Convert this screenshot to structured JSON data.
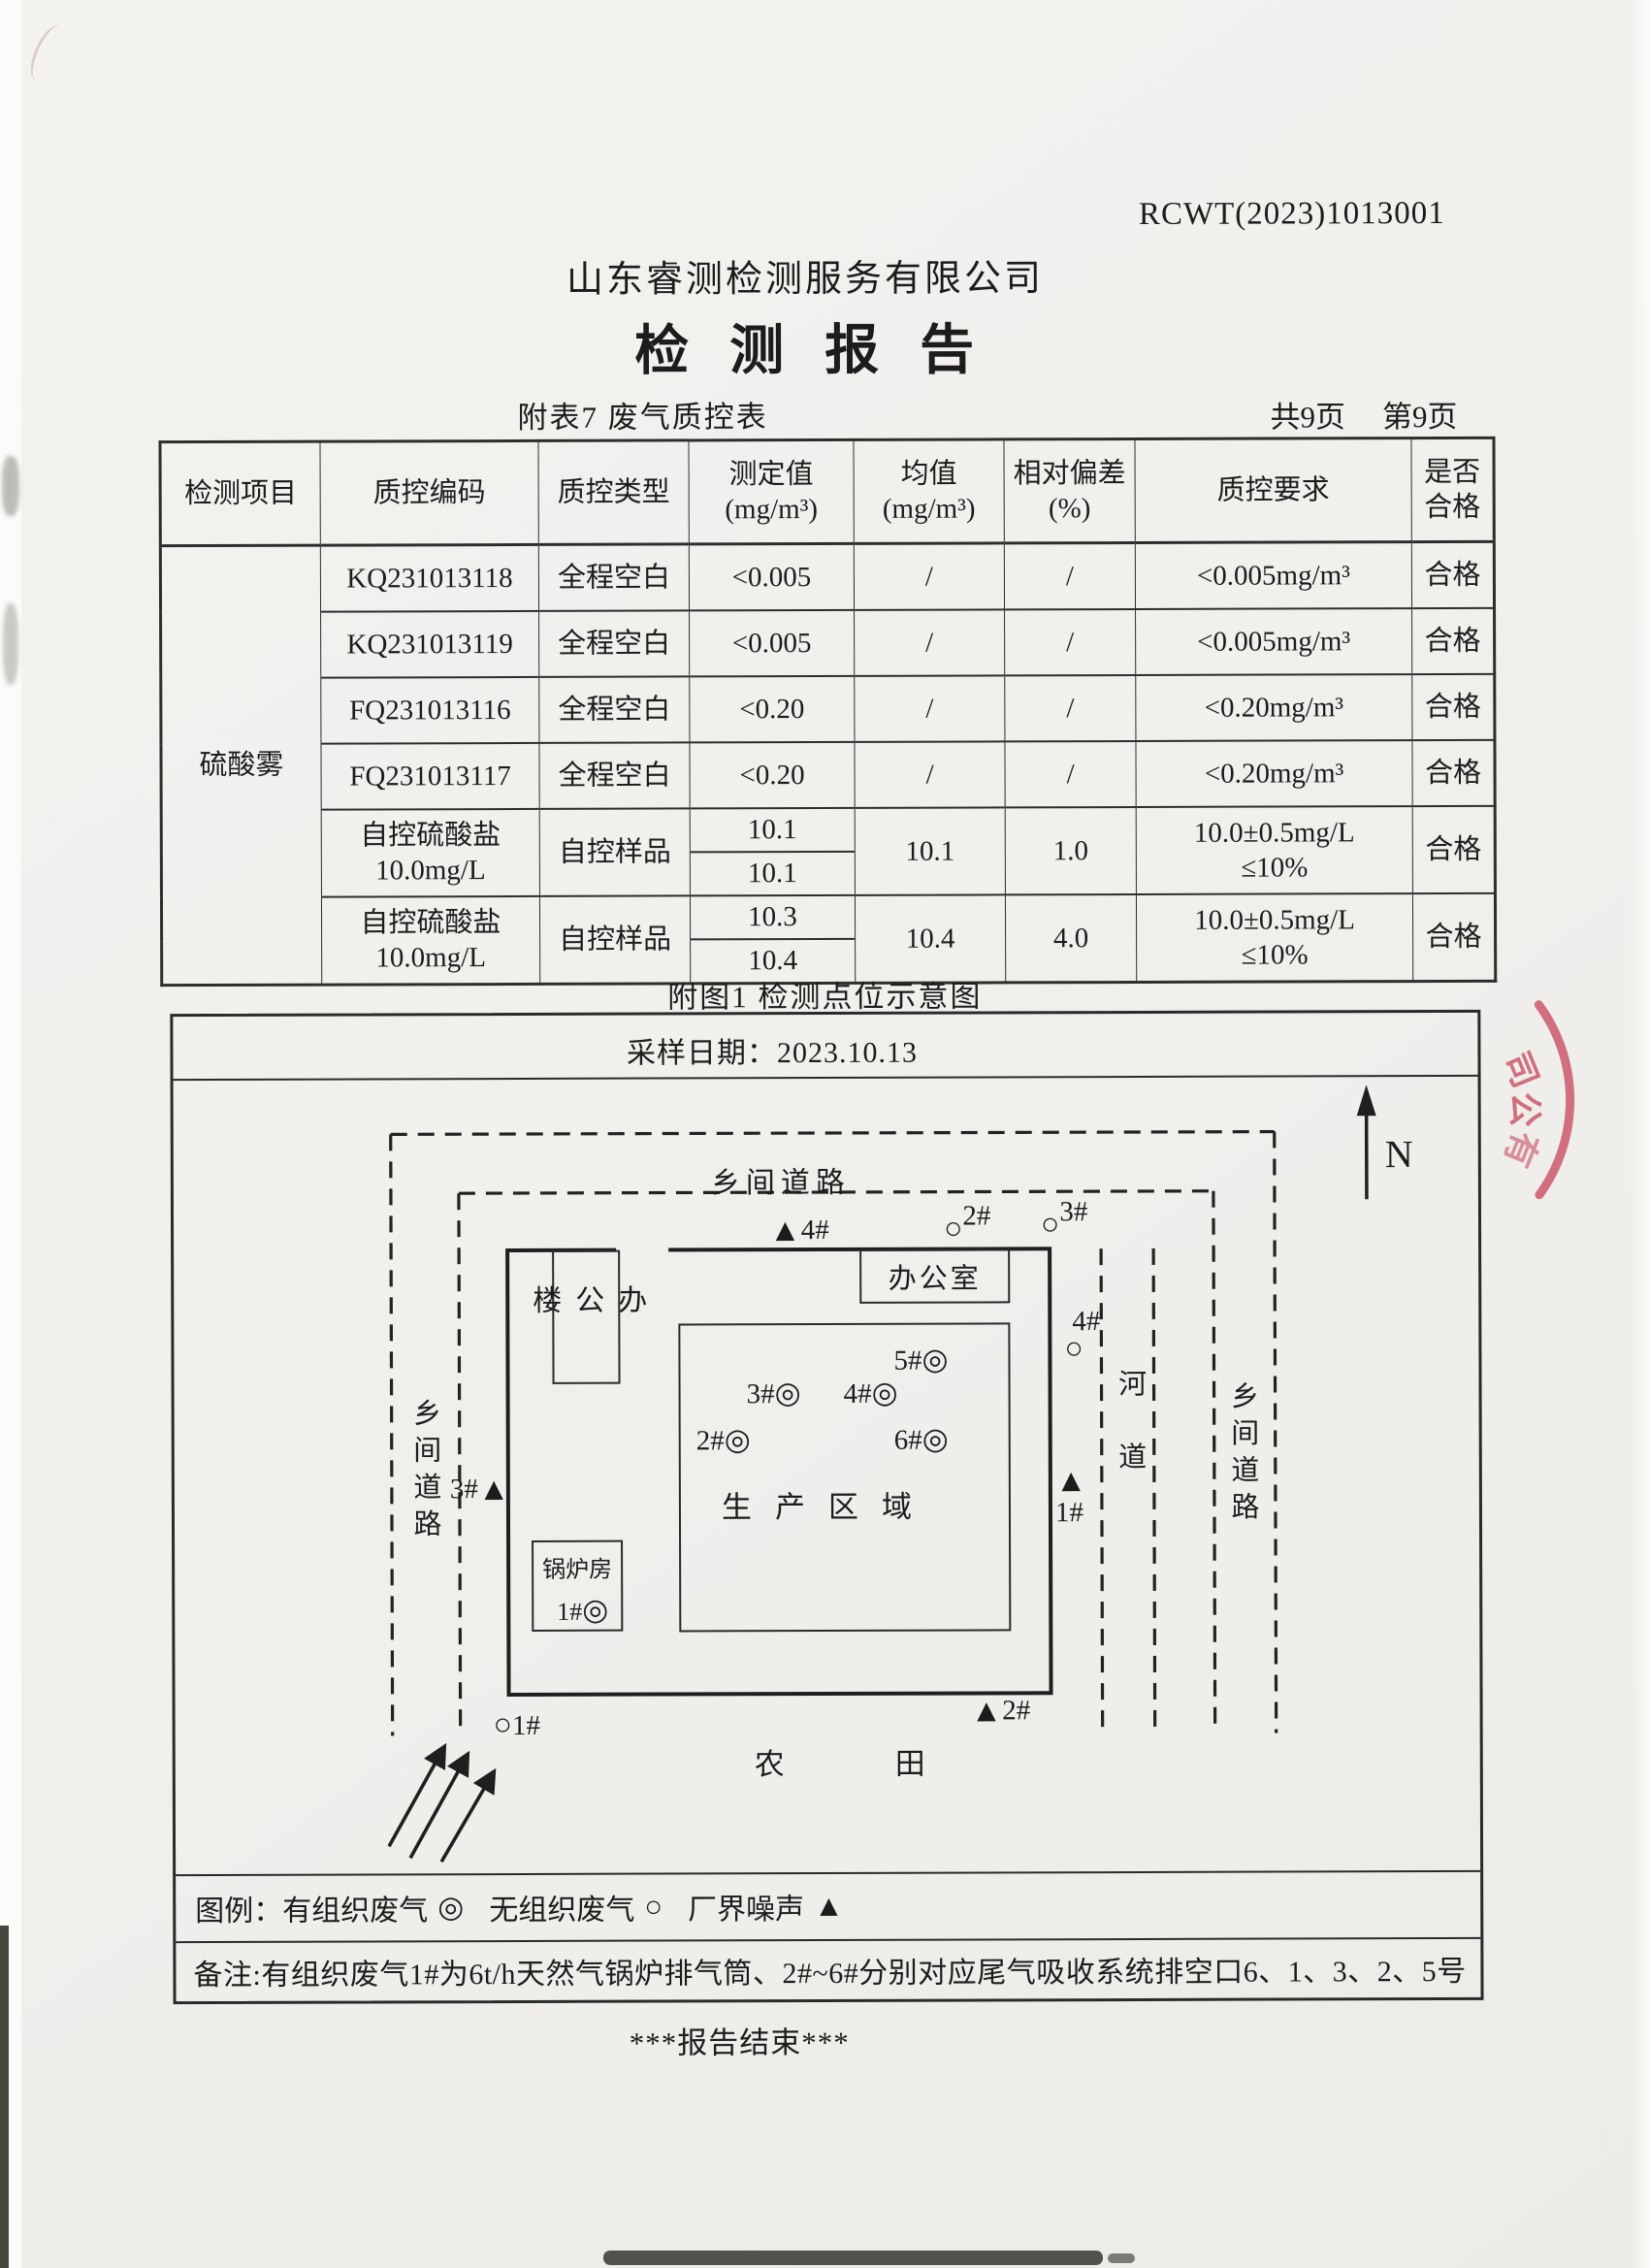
{
  "doc": {
    "report_no": "RCWT(2023)1013001",
    "company": "山东睿测检测服务有限公司",
    "title": "检 测 报 告",
    "subtable_caption": "附表7 废气质控表",
    "pages_total": "共9页",
    "page_current": "第9页",
    "figure_caption": "附图1 检测点位示意图",
    "end_text": "***报告结束***"
  },
  "table": {
    "headers": {
      "item": "检测项目",
      "code": "质控编码",
      "type": "质控类型",
      "measured": "测定值\n(mg/m³)",
      "mean": "均值\n(mg/m³)",
      "deviation": "相对偏差\n(%)",
      "requirement": "质控要求",
      "pass": "是否\n合格"
    },
    "item": "硫酸雾",
    "blank_rows": [
      {
        "code": "KQ231013118",
        "type": "全程空白",
        "measured": "<0.005",
        "mean": "/",
        "deviation": "/",
        "requirement": "<0.005mg/m³",
        "pass": "合格"
      },
      {
        "code": "KQ231013119",
        "type": "全程空白",
        "measured": "<0.005",
        "mean": "/",
        "deviation": "/",
        "requirement": "<0.005mg/m³",
        "pass": "合格"
      },
      {
        "code": "FQ231013116",
        "type": "全程空白",
        "measured": "<0.20",
        "mean": "/",
        "deviation": "/",
        "requirement": "<0.20mg/m³",
        "pass": "合格"
      },
      {
        "code": "FQ231013117",
        "type": "全程空白",
        "measured": "<0.20",
        "mean": "/",
        "deviation": "/",
        "requirement": "<0.20mg/m³",
        "pass": "合格"
      }
    ],
    "control_rows": [
      {
        "code": "自控硫酸盐\n10.0mg/L",
        "type": "自控样品",
        "measured1": "10.1",
        "measured2": "10.1",
        "mean": "10.1",
        "deviation": "1.0",
        "requirement": "10.0±0.5mg/L\n≤10%",
        "pass": "合格"
      },
      {
        "code": "自控硫酸盐\n10.0mg/L",
        "type": "自控样品",
        "measured1": "10.3",
        "measured2": "10.4",
        "mean": "10.4",
        "deviation": "4.0",
        "requirement": "10.0±0.5mg/L\n≤10%",
        "pass": "合格"
      }
    ]
  },
  "figure": {
    "sampling_date": "采样日期：2023.10.13",
    "compass": "N",
    "roads": {
      "top": "乡间道路",
      "left": "乡间道路",
      "right": "乡间道路",
      "river": "河道"
    },
    "buildings": {
      "office_building": "办公楼",
      "office": "办公室",
      "production_area": "生产区域",
      "boiler_room": "锅炉房",
      "farmland_char1": "农",
      "farmland_char2": "田"
    },
    "points": {
      "t4": {
        "label": "4#",
        "symbol": "▲"
      },
      "t3": {
        "label": "3#",
        "symbol": "▲"
      },
      "t1": {
        "label": "1#",
        "symbol": "▲"
      },
      "t2": {
        "label": "2#",
        "symbol": "▲"
      },
      "c1": {
        "label": "1#",
        "symbol": "○"
      },
      "c2": {
        "label": "2#",
        "symbol": "○"
      },
      "c3": {
        "label": "3#",
        "symbol": "○"
      },
      "c4": {
        "label": "4#",
        "symbol": "○"
      },
      "g1": {
        "label": "1#",
        "symbol": "◎"
      },
      "g2": {
        "label": "2#",
        "symbol": "◎"
      },
      "g3": {
        "label": "3#",
        "symbol": "◎"
      },
      "g4": {
        "label": "4#",
        "symbol": "◎"
      },
      "g5": {
        "label": "5#",
        "symbol": "◎"
      },
      "g6": {
        "label": "6#",
        "symbol": "◎"
      }
    },
    "legend": {
      "prefix": "图例：",
      "organized": "有组织废气",
      "organized_symbol": "◎",
      "unorganized": "无组织废气",
      "unorganized_symbol": "○",
      "noise": "厂界噪声",
      "noise_symbol": "▲"
    },
    "note": "备注:有组织废气1#为6t/h天然气锅炉排气筒、2#~6#分别对应尾气吸收系统排空口6、1、3、2、5号"
  },
  "stamp": {
    "char1": "司",
    "char2": "公",
    "char3": "有",
    "color": "#c94f63"
  }
}
